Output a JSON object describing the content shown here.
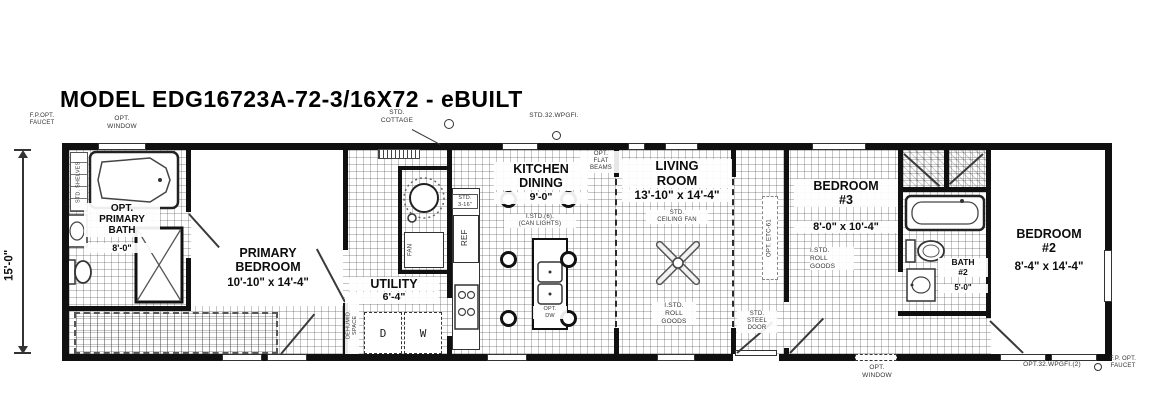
{
  "title": "MODEL EDG16723A-72-3/16X72 - eBUILT",
  "dimension": {
    "height": "15'-0\""
  },
  "rooms": {
    "primary_bath": {
      "name": "OPT.\nPRIMARY\nBATH",
      "size": "8'-0\""
    },
    "primary_bedroom": {
      "name": "PRIMARY\nBEDROOM",
      "size": "10'-10\" x 14'-4\""
    },
    "utility": {
      "name": "UTILITY",
      "size": "6'-4\""
    },
    "kitchen_dining": {
      "name": "KITCHEN\nDINING",
      "size": "9'-0\""
    },
    "living_room": {
      "name": "LIVING\nROOM",
      "size": "13'-10\" x 14'-4\""
    },
    "bedroom_3": {
      "name": "BEDROOM\n#3",
      "size": "8'-0\" x 10'-4\""
    },
    "bath_2": {
      "name": "BATH\n#2",
      "size": "5'-0\""
    },
    "bedroom_2": {
      "name": "BEDROOM\n#2",
      "size": "8'-4\" x 14'-4\""
    }
  },
  "annotations": {
    "fp_opt_faucet_top": "F.P.OPT.\nFAUCET",
    "opt_window_top": "OPT.\nWINDOW",
    "std_cottage": "STD.\nCOTTAGE",
    "std_32_wpgfi": "STD.32.WPGFI.",
    "opt_flat_beams": "OPT.\nFLAT\nBEAMS",
    "std_ceiling_fan": "STD.\nCEILING FAN",
    "can_lights": "I.STD.(6).\n(CAN LIGHTS)",
    "roll_goods_living": "I.STD.\nROLL\nGOODS",
    "roll_goods_bedroom3": "I.STD.\nROLL\nGOODS",
    "opt_etc_61": "OPT. ETC-61",
    "std_steel_door": "STD.\nSTEEL\nDOOR",
    "std_shelves": "STD. SHELVES",
    "dehumid_space": "DEHUMID.\nSPACE",
    "std_3_16": "STD.\n3-16\"",
    "pb": "PB",
    "opt_dw": "OPT.\nDW",
    "opt_window_bottom": "OPT.\nWINDOW",
    "opt_32_wpgfi_2": "OPT.32.WPGFI.(2)",
    "fp_opt_faucet_bottom": "F.P. OPT.\nFAUCET"
  },
  "appliances": {
    "refrigerator": "REF",
    "fan": "FAN",
    "dryer": "D",
    "washer": "W"
  }
}
